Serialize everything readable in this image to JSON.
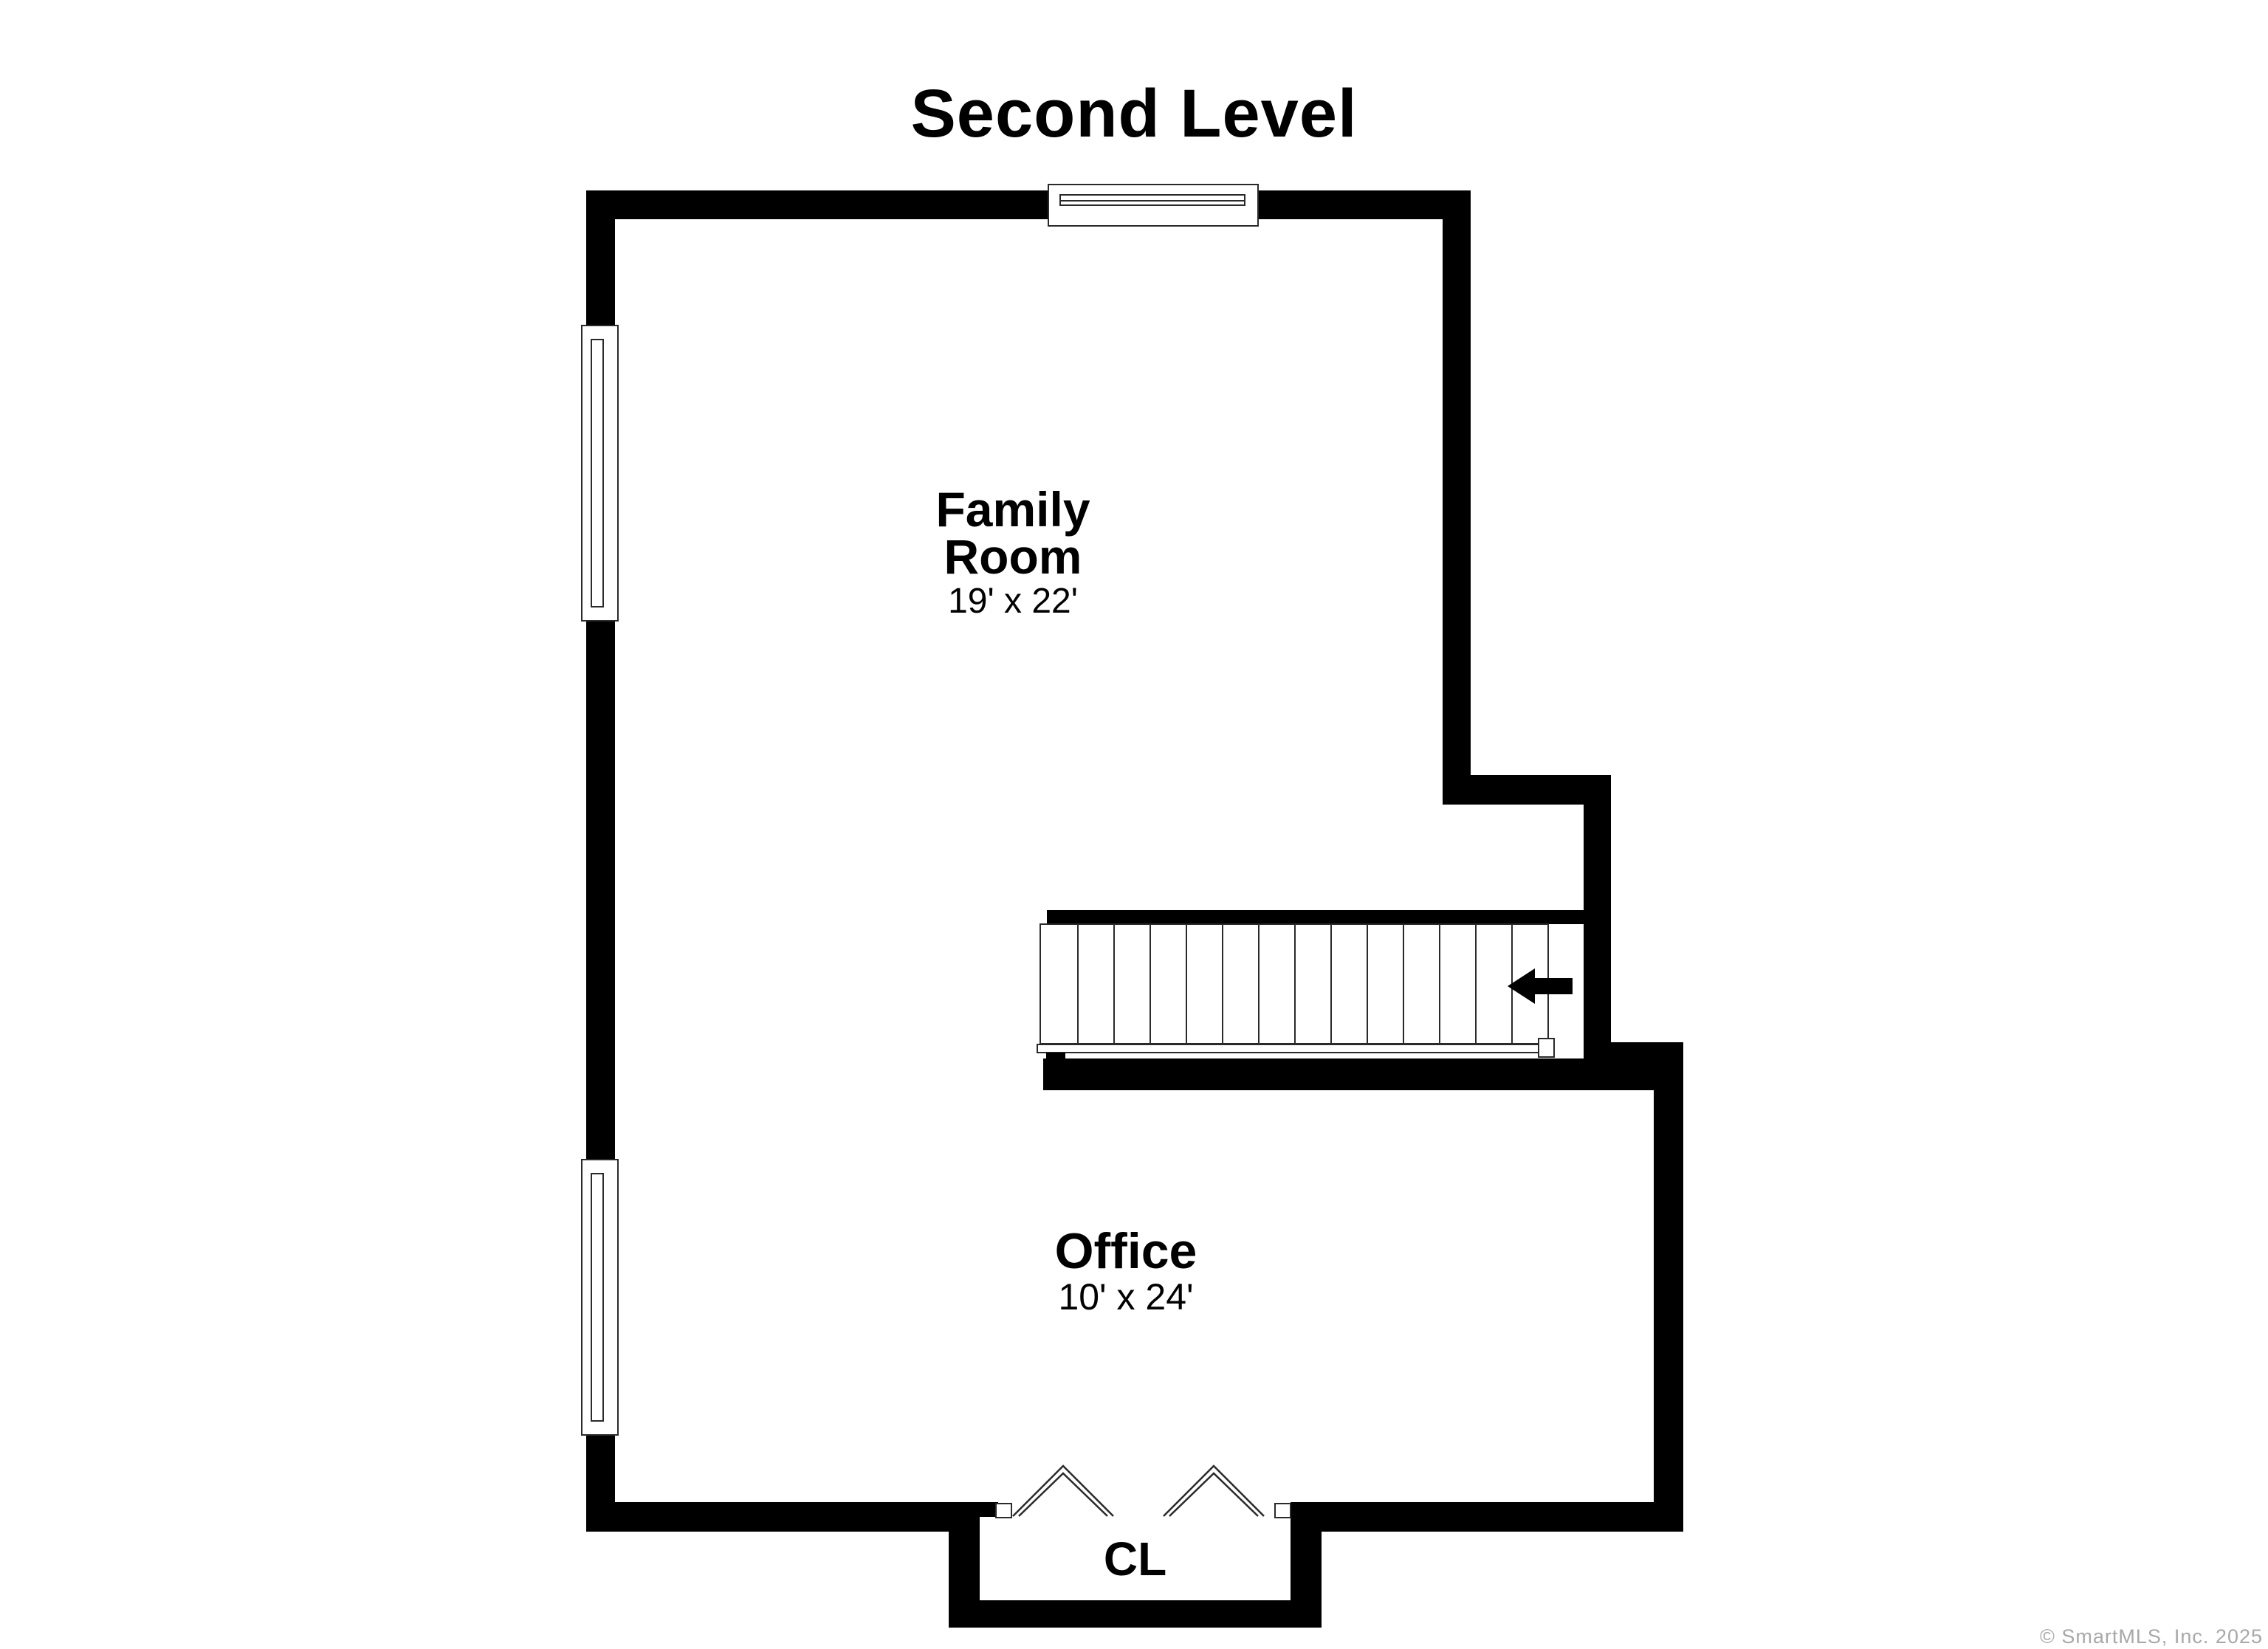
{
  "title": "Second Level",
  "rooms": [
    {
      "id": "family-room",
      "name": "Family Room",
      "name_line1": "Family",
      "name_line2": "Room",
      "dimensions": "19' x 22'"
    },
    {
      "id": "office",
      "name": "Office",
      "dimensions": "10' x 24'"
    },
    {
      "id": "closet",
      "name": "CL"
    }
  ],
  "stairs": {
    "tread_count": 14,
    "direction_arrow": "left"
  },
  "features": {
    "windows": [
      "top-wall-window",
      "left-wall-upper-window",
      "left-wall-lower-window"
    ],
    "doors": [
      "closet-bifold-doors"
    ]
  },
  "colors": {
    "wall": "#000000",
    "line": "#2a2a2a",
    "bg": "#ffffff",
    "watermark": "#a8a8a8"
  },
  "watermark": "© SmartMLS, Inc. 2025"
}
